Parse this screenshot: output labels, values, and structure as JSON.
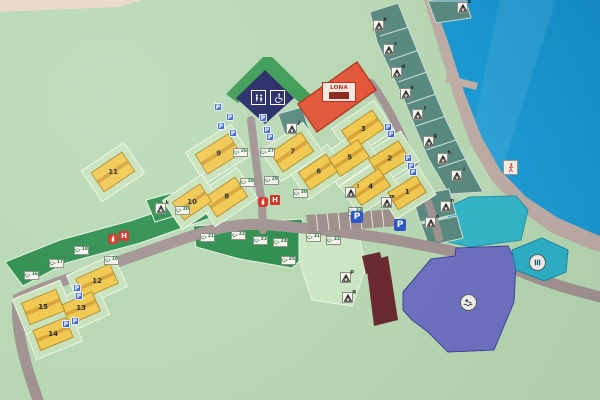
{
  "map": {
    "main_building_label": "LONA",
    "glyphs": {
      "parking": "P",
      "hydrant": "H"
    },
    "colors": {
      "land": "#b8d9b4",
      "water": "#1b9ad3",
      "beach": "#c0aea7",
      "road": "#a29492",
      "pitch_green": "#2e8f4e",
      "pitch_teal": "#5a8b80",
      "building_yellow": "#f1c94f",
      "main_building_orange": "#e2573a",
      "sanitary_navy": "#262a66",
      "barn_maroon": "#6b2b30",
      "hall_purple": "#6e72c2",
      "pond_cyan": "#35b7cb",
      "sign_blue": "#2c57c8",
      "sign_red": "#d23227"
    },
    "buildings": [
      {
        "label": "1",
        "x": 407,
        "y": 192,
        "w": 34,
        "h": 21,
        "r": -32
      },
      {
        "label": "2",
        "x": 389,
        "y": 159,
        "w": 36,
        "h": 22,
        "r": -32
      },
      {
        "label": "3",
        "x": 363,
        "y": 129,
        "w": 38,
        "h": 23,
        "r": -34
      },
      {
        "label": "4",
        "x": 370,
        "y": 187,
        "w": 36,
        "h": 22,
        "r": -34
      },
      {
        "label": "5",
        "x": 349,
        "y": 158,
        "w": 36,
        "h": 22,
        "r": -34
      },
      {
        "label": "6",
        "x": 318,
        "y": 172,
        "w": 34,
        "h": 22,
        "r": -34
      },
      {
        "label": "7",
        "x": 292,
        "y": 152,
        "w": 38,
        "h": 24,
        "r": -34
      },
      {
        "label": "8",
        "x": 226,
        "y": 197,
        "w": 38,
        "h": 24,
        "r": -34
      },
      {
        "label": "9",
        "x": 218,
        "y": 154,
        "w": 40,
        "h": 24,
        "r": -32
      },
      {
        "label": "10",
        "x": 192,
        "y": 202,
        "w": 34,
        "h": 22,
        "r": -34
      },
      {
        "label": "11",
        "x": 113,
        "y": 172,
        "w": 38,
        "h": 24,
        "r": -34
      },
      {
        "label": "12",
        "x": 97,
        "y": 281,
        "w": 38,
        "h": 22,
        "r": -24
      },
      {
        "label": "13",
        "x": 81,
        "y": 308,
        "w": 34,
        "h": 22,
        "r": -24
      },
      {
        "label": "14",
        "x": 53,
        "y": 334,
        "w": 36,
        "h": 22,
        "r": -22
      },
      {
        "label": "15",
        "x": 43,
        "y": 307,
        "w": 38,
        "h": 24,
        "r": -22
      }
    ],
    "tent_pitches": [
      {
        "id": "a",
        "x": 462,
        "y": 7
      },
      {
        "id": "b",
        "x": 378,
        "y": 25
      },
      {
        "id": "c",
        "x": 388,
        "y": 49
      },
      {
        "id": "d",
        "x": 396,
        "y": 72
      },
      {
        "id": "e",
        "x": 405,
        "y": 93
      },
      {
        "id": "f",
        "x": 417,
        "y": 114
      },
      {
        "id": "g",
        "x": 428,
        "y": 141
      },
      {
        "id": "h",
        "x": 442,
        "y": 158
      },
      {
        "id": "i",
        "x": 456,
        "y": 175
      },
      {
        "id": "j",
        "x": 291,
        "y": 128
      },
      {
        "id": "k",
        "x": 160,
        "y": 208
      },
      {
        "id": "l",
        "x": 350,
        "y": 192
      },
      {
        "id": "m",
        "x": 386,
        "y": 202
      },
      {
        "id": "n",
        "x": 445,
        "y": 206
      },
      {
        "id": "o",
        "x": 430,
        "y": 222
      },
      {
        "id": "p",
        "x": 345,
        "y": 277
      },
      {
        "id": "q",
        "x": 347,
        "y": 297
      }
    ],
    "caravan_pitches": [
      {
        "num": "16",
        "x": 31,
        "y": 275
      },
      {
        "num": "17",
        "x": 56,
        "y": 263
      },
      {
        "num": "18",
        "x": 81,
        "y": 250
      },
      {
        "num": "19",
        "x": 111,
        "y": 260
      },
      {
        "num": "20",
        "x": 182,
        "y": 210
      },
      {
        "num": "21",
        "x": 207,
        "y": 237
      },
      {
        "num": "22",
        "x": 238,
        "y": 235
      },
      {
        "num": "23",
        "x": 260,
        "y": 240
      },
      {
        "num": "24",
        "x": 280,
        "y": 242
      },
      {
        "num": "25",
        "x": 288,
        "y": 260
      },
      {
        "num": "26",
        "x": 240,
        "y": 152
      },
      {
        "num": "27",
        "x": 267,
        "y": 152
      },
      {
        "num": "28",
        "x": 247,
        "y": 182
      },
      {
        "num": "29",
        "x": 271,
        "y": 180
      },
      {
        "num": "30",
        "x": 300,
        "y": 193
      },
      {
        "num": "31",
        "x": 313,
        "y": 237
      },
      {
        "num": "32",
        "x": 333,
        "y": 240
      },
      {
        "num": "33",
        "x": 355,
        "y": 211
      }
    ],
    "parking_tags": [
      {
        "x": 218,
        "y": 107
      },
      {
        "x": 230,
        "y": 117
      },
      {
        "x": 221,
        "y": 126
      },
      {
        "x": 233,
        "y": 133
      },
      {
        "x": 263,
        "y": 118
      },
      {
        "x": 267,
        "y": 130
      },
      {
        "x": 270,
        "y": 137
      },
      {
        "x": 388,
        "y": 127
      },
      {
        "x": 391,
        "y": 134
      },
      {
        "x": 408,
        "y": 158
      },
      {
        "x": 411,
        "y": 166
      },
      {
        "x": 413,
        "y": 172
      },
      {
        "x": 77,
        "y": 288
      },
      {
        "x": 79,
        "y": 296
      },
      {
        "x": 66,
        "y": 324
      },
      {
        "x": 75,
        "y": 321
      }
    ],
    "parking_signs": [
      {
        "x": 357,
        "y": 217
      },
      {
        "x": 400,
        "y": 225
      }
    ],
    "emergency_signs": [
      {
        "type": "extinguisher",
        "x": 263,
        "y": 202
      },
      {
        "type": "hydrant",
        "x": 275,
        "y": 200
      },
      {
        "type": "extinguisher",
        "x": 113,
        "y": 239
      },
      {
        "type": "hydrant",
        "x": 124,
        "y": 236
      }
    ]
  }
}
